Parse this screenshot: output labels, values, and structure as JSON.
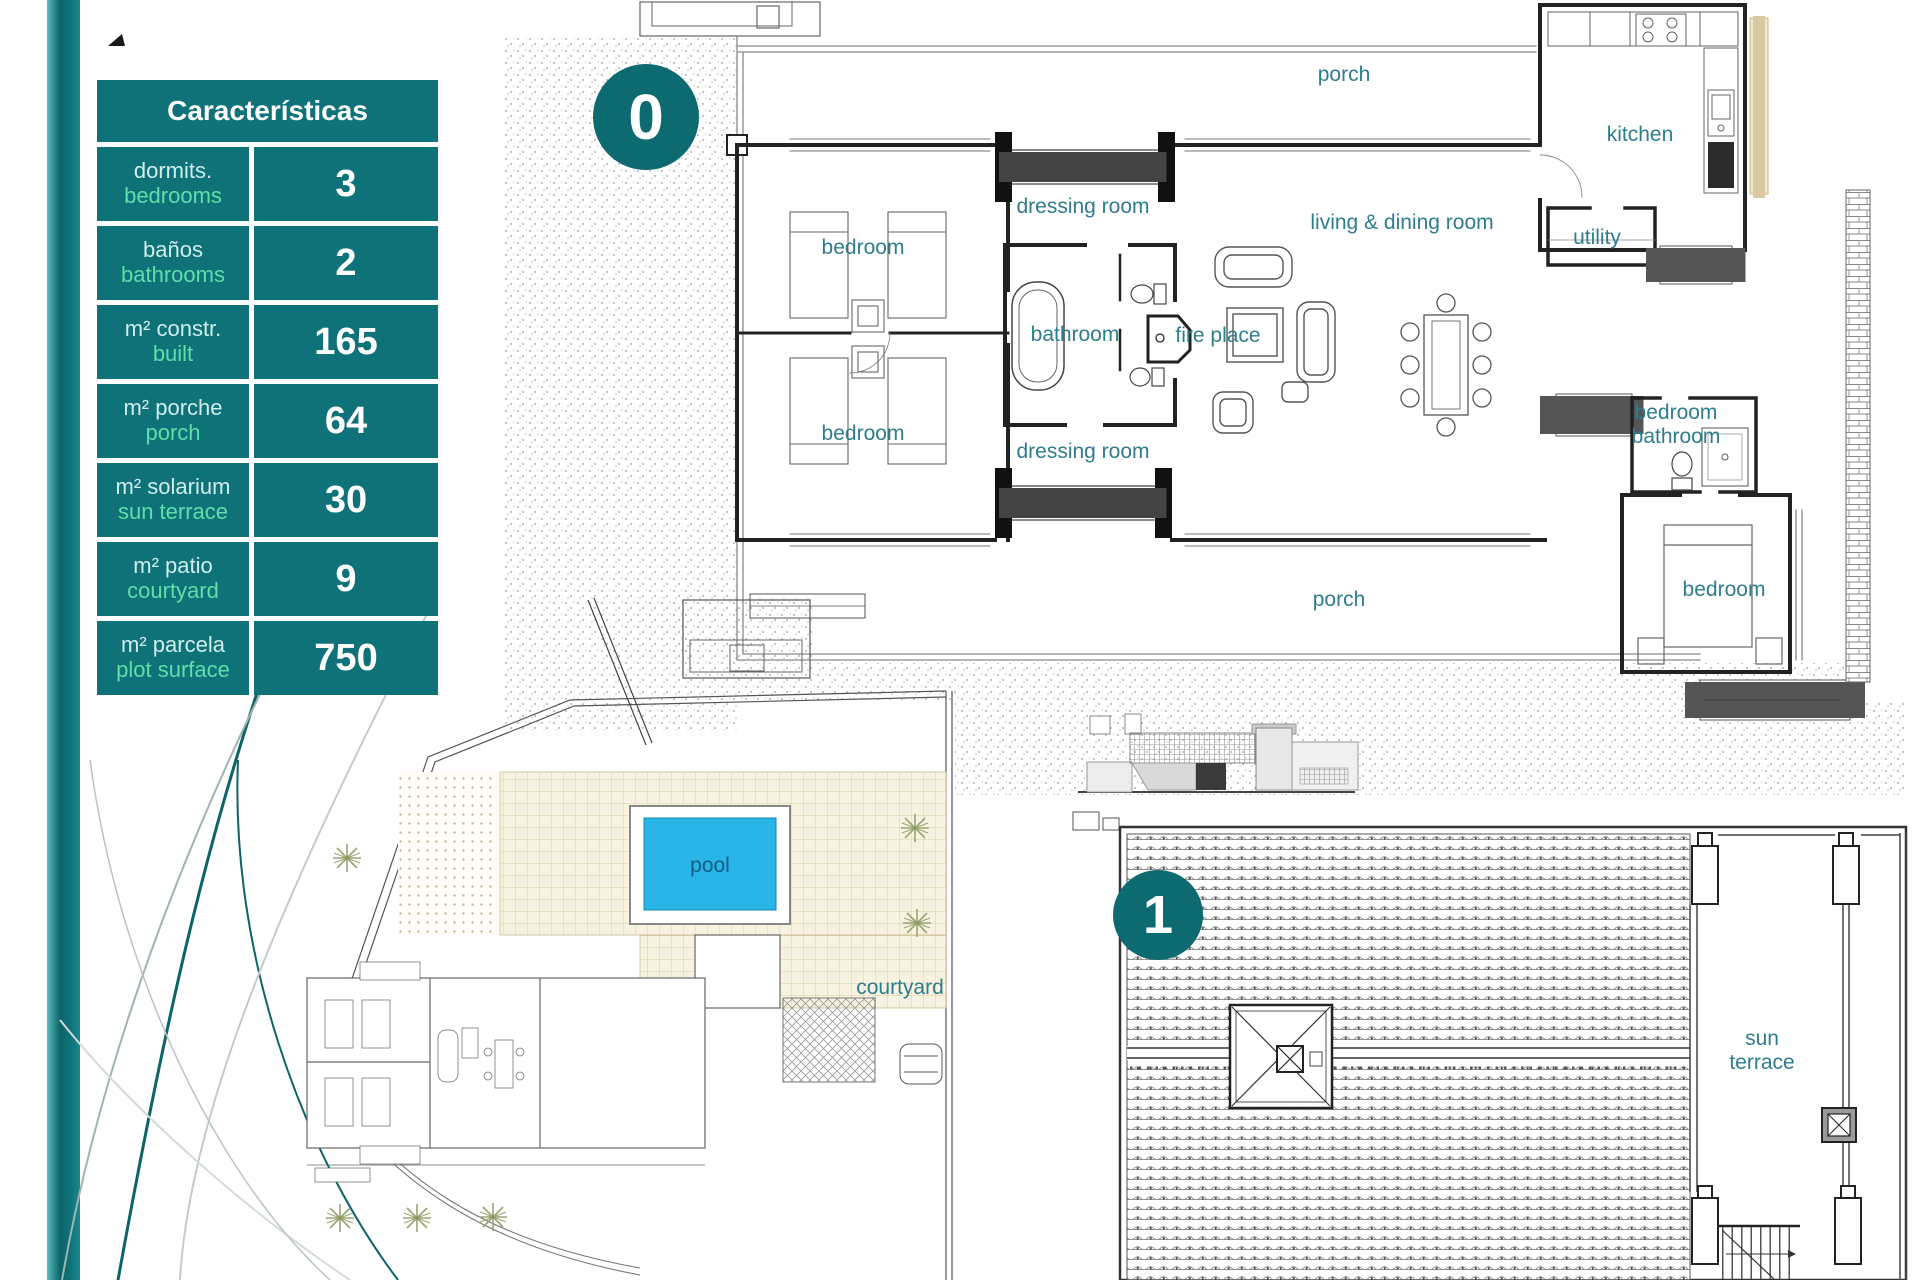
{
  "colors": {
    "table_teal": "#0f7278",
    "accent_mint": "#5fdfa7",
    "label_teal": "#2e7d8e",
    "pool_blue": "#29b5e8",
    "terrace_tan": "#f8f3e0"
  },
  "table": {
    "title": "Características",
    "rows": [
      {
        "es": "dormits.",
        "en": "bedrooms",
        "value": "3"
      },
      {
        "es": "baños",
        "en": "bathrooms",
        "value": "2"
      },
      {
        "es": "m² constr.",
        "en": "built",
        "value": "165"
      },
      {
        "es": "m² porche",
        "en": "porch",
        "value": "64"
      },
      {
        "es": "m² solarium",
        "en": "sun terrace",
        "value": "30"
      },
      {
        "es": "m² patio",
        "en": "courtyard",
        "value": "9"
      },
      {
        "es": "m² parcela",
        "en": "plot surface",
        "value": "750"
      }
    ]
  },
  "floor_markers": {
    "ground": "0",
    "first": "1"
  },
  "plan0_labels": {
    "porch_top": "porch",
    "kitchen": "kitchen",
    "dressing_top": "dressing room",
    "living": "living & dining room",
    "utility": "utility",
    "bedroom_tl": "bedroom",
    "bathroom": "bathroom",
    "fireplace": "fire place",
    "bedroom_ml": "bedroom",
    "dressing_bottom": "dressing room",
    "bed_bath_right": "bedroom bathroom",
    "bedroom_br": "bedroom",
    "porch_bottom": "porch"
  },
  "site_labels": {
    "pool": "pool",
    "courtyard": "courtyard"
  },
  "roof_labels": {
    "sun_terrace": "sun terrace"
  }
}
